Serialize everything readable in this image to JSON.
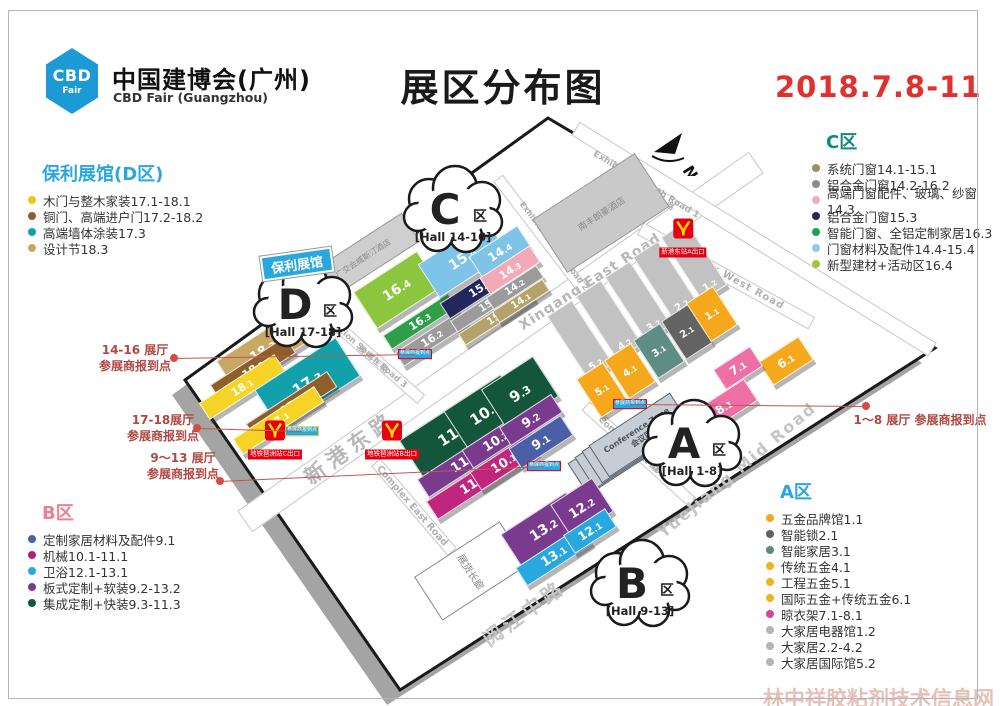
{
  "header": {
    "logo_main": "CBD",
    "logo_sub": "Fair",
    "org_cn": "中国建博会(广州)",
    "org_en": "CBD Fair (Guangzhou)",
    "title": "展区分布图",
    "date": "2018.7.8-11"
  },
  "legends": {
    "d": {
      "title": "保利展馆(D区)",
      "title_color": "#2AA7DF",
      "items": [
        {
          "color": "#F0C419",
          "label": "木门与整木家装17.1-18.1"
        },
        {
          "color": "#8F5F2B",
          "label": "铜门、高端进户门17.2-18.2"
        },
        {
          "color": "#12A0AA",
          "label": "高端墙体涂装17.3"
        },
        {
          "color": "#C9A765",
          "label": "设计节18.3"
        }
      ]
    },
    "c": {
      "title": "C区",
      "title_color": "#14887A",
      "items": [
        {
          "color": "#9D8D62",
          "label": "系统门窗14.1-15.1"
        },
        {
          "color": "#8C8C8C",
          "label": "铝合金门窗14.2-16.2"
        },
        {
          "color": "#F2A9B8",
          "label": "高端门窗配件、玻璃、纱窗14.3"
        },
        {
          "color": "#23275B",
          "label": "铝合金门窗15.3"
        },
        {
          "color": "#1E9E50",
          "label": "智能门窗、全铝定制家居16.3"
        },
        {
          "color": "#8EC8EA",
          "label": "门窗材料及配件14.4-15.4"
        },
        {
          "color": "#9AC93E",
          "label": "新型建材+活动区16.4"
        }
      ]
    },
    "b": {
      "title": "B区",
      "title_color": "#EB8093",
      "items": [
        {
          "color": "#4A5FA5",
          "label": "定制家居材料及配件9.1"
        },
        {
          "color": "#B01F7C",
          "label": "机械10.1-11.1"
        },
        {
          "color": "#29ABE2",
          "label": "卫浴12.1-13.1"
        },
        {
          "color": "#7A3B8F",
          "label": "板式定制+软装9.2-13.2"
        },
        {
          "color": "#0E5A3C",
          "label": "集成定制+快装9.3-11.3"
        }
      ]
    },
    "a": {
      "title": "A区",
      "title_color": "#2AA7DF",
      "items": [
        {
          "color": "#F2A71F",
          "label": "五金品牌馆1.1"
        },
        {
          "color": "#5F6062",
          "label": "智能锁2.1"
        },
        {
          "color": "#5B8A86",
          "label": "智能家居3.1"
        },
        {
          "color": "#F0B41F",
          "label": "传统五金4.1"
        },
        {
          "color": "#F0B41F",
          "label": "工程五金5.1"
        },
        {
          "color": "#F0B41F",
          "label": "国际五金+传统五金6.1"
        },
        {
          "color": "#D4439C",
          "label": "晾衣架7.1-8.1"
        },
        {
          "color": "#B5B5B5",
          "label": "大家居电器馆1.2"
        },
        {
          "color": "#B5B5B5",
          "label": "大家居2.2-4.2"
        },
        {
          "color": "#B5B5B5",
          "label": "大家居国际馆5.2"
        }
      ]
    }
  },
  "map": {
    "north": "N",
    "poly_tag": "保利展馆",
    "boundary": [
      [
        548,
        118
      ],
      [
        935,
        348
      ],
      [
        400,
        690
      ],
      [
        185,
        380
      ]
    ],
    "roads": [
      {
        "name": "xingang-east-road",
        "x1": 245,
        "y1": 520,
        "x2": 755,
        "y2": 162,
        "w": 24
      },
      {
        "name": "exhibition-south-road-1",
        "x1": 575,
        "y1": 128,
        "x2": 930,
        "y2": 348,
        "w": 14
      },
      {
        "name": "complex-west-road",
        "x1": 640,
        "y1": 228,
        "x2": 810,
        "y2": 322,
        "w": 12
      },
      {
        "name": "exhibition-south-road-2",
        "x1": 498,
        "y1": 178,
        "x2": 608,
        "y2": 322,
        "w": 10
      },
      {
        "name": "exhibition-south-road-3",
        "x1": 320,
        "y1": 310,
        "x2": 420,
        "y2": 398,
        "w": 10
      },
      {
        "name": "complex-mid-road",
        "x1": 585,
        "y1": 405,
        "x2": 690,
        "y2": 500,
        "w": 10
      },
      {
        "name": "complex-east-road",
        "x1": 375,
        "y1": 462,
        "x2": 450,
        "y2": 550,
        "w": 10
      }
    ],
    "road_labels": [
      {
        "name": "xingang-east-road-cn",
        "text": "新港东路",
        "x": 350,
        "y": 447,
        "rot": -36,
        "size": 21,
        "ls": 6,
        "color": "#b8b8b8"
      },
      {
        "name": "xingang-east-road-en",
        "text": "Xingang East Road",
        "x": 590,
        "y": 282,
        "rot": -33,
        "size": 14,
        "ls": 1,
        "color": "#b8b8b8"
      },
      {
        "name": "exhibition-south-road-1-en",
        "text": "Exhibition South Road 1",
        "x": 646,
        "y": 185,
        "rot": 31,
        "size": 9,
        "ls": 0,
        "color": "#b0b0b0"
      },
      {
        "name": "exhibition-south-road-1-cn",
        "text": "展南一路",
        "x": 658,
        "y": 199,
        "rot": 31,
        "size": 8,
        "ls": 2,
        "color": "#b0b0b0"
      },
      {
        "name": "complex-west-road-en",
        "text": "Complex West Road",
        "x": 727,
        "y": 276,
        "rot": 29,
        "size": 10,
        "ls": 1,
        "color": "#b0b0b0"
      },
      {
        "name": "exhibition-south-road-2-en",
        "text": "Exhibition South Road 2",
        "x": 554,
        "y": 246,
        "rot": 53,
        "size": 8,
        "ls": 0,
        "color": "#b0b0b0"
      },
      {
        "name": "exhibition-south-road-2-cn",
        "text": "展南二路",
        "x": 566,
        "y": 254,
        "rot": 53,
        "size": 7.5,
        "ls": 2,
        "color": "#b0b0b0"
      },
      {
        "name": "exhibition-south-road-3-en",
        "text": "Exhibition South Road 3",
        "x": 362,
        "y": 349,
        "rot": 41,
        "size": 8.5,
        "ls": 0,
        "color": "#b0b0b0"
      },
      {
        "name": "exhibition-south-road-3-cn",
        "text": "展南三路",
        "x": 374,
        "y": 360,
        "rot": 41,
        "size": 8,
        "ls": 2,
        "color": "#b0b0b0"
      },
      {
        "name": "complex-mid-road-en",
        "text": "Complex Mid Road",
        "x": 634,
        "y": 450,
        "rot": 42,
        "size": 9,
        "ls": 0,
        "color": "#b0b0b0"
      },
      {
        "name": "complex-mid-road-cn",
        "text": "展览中路",
        "x": 645,
        "y": 459,
        "rot": 42,
        "size": 8,
        "ls": 2,
        "color": "#b0b0b0"
      },
      {
        "name": "complex-east-road-en",
        "text": "Complex East Road",
        "x": 412,
        "y": 506,
        "rot": 49,
        "size": 9.5,
        "ls": 0,
        "color": "#b0b0b0"
      },
      {
        "name": "yuejiang-mid-road-en",
        "text": "Yuejiang Mid Road",
        "x": 737,
        "y": 470,
        "rot": -40,
        "size": 16,
        "ls": 2,
        "color": "#c5c5c5"
      },
      {
        "name": "yuejiang-mid-road-cn",
        "text": "阅江中路",
        "x": 523,
        "y": 612,
        "rot": -36,
        "size": 20,
        "ls": 4,
        "color": "#c5c5c5"
      }
    ],
    "buildings": [
      {
        "name": "nanfeng-langham-hotel",
        "label": "南丰朗豪酒店",
        "x": 600,
        "y": 212,
        "w": 120,
        "h": 62,
        "fill": "#C9C9C9",
        "border": "#9a9a9a",
        "fz": 9
      },
      {
        "name": "westin-hotel",
        "label": "广交会威斯汀酒店",
        "x": 362,
        "y": 257,
        "w": 112,
        "h": 32,
        "fill": "#CFCFCF",
        "border": "#9a9a9a",
        "fz": 8
      },
      {
        "name": "exhibition-corridor",
        "label": "展货长廊",
        "x": 470,
        "y": 570,
        "w": 100,
        "h": 50,
        "fill": "#ffffff",
        "border": "#8a8a8a",
        "fz": 10,
        "vert": true
      }
    ],
    "conference": {
      "x": 617,
      "y": 452,
      "w": 95,
      "h": 36,
      "label_en": "Conference Zone",
      "label_cn": "会议区"
    },
    "halls": [
      {
        "id": "18.3",
        "x": 262,
        "y": 350,
        "w": 88,
        "h": 32,
        "c": "#C9A765",
        "fz": 13
      },
      {
        "id": "18.2",
        "x": 252,
        "y": 368,
        "w": 88,
        "h": 18,
        "c": "#8F5F2B",
        "fz": 11
      },
      {
        "id": "18.1",
        "x": 241,
        "y": 386,
        "w": 88,
        "h": 18,
        "c": "#F5D327",
        "fz": 11
      },
      {
        "id": "17.3",
        "x": 306,
        "y": 382,
        "w": 95,
        "h": 44,
        "c": "#12A0AA",
        "fz": 15
      },
      {
        "id": "17.2",
        "x": 290,
        "y": 404,
        "w": 95,
        "h": 17,
        "c": "#8F5F2B",
        "fz": 11
      },
      {
        "id": "17.1",
        "x": 277,
        "y": 419,
        "w": 95,
        "h": 17,
        "c": "#F5D327",
        "fz": 11
      },
      {
        "id": "16.4",
        "x": 396,
        "y": 289,
        "w": 74,
        "h": 42,
        "c": "#8CC63E",
        "fz": 14
      },
      {
        "id": "16.3",
        "x": 419,
        "y": 320,
        "w": 76,
        "h": 15,
        "c": "#2E9E4B",
        "fz": 11
      },
      {
        "id": "16.2",
        "x": 431,
        "y": 337,
        "w": 76,
        "h": 15,
        "c": "#9B9B9B",
        "fz": 11
      },
      {
        "id": "15.4",
        "x": 462,
        "y": 258,
        "w": 80,
        "h": 38,
        "c": "#7EC3E8",
        "fz": 14
      },
      {
        "id": "15.3",
        "x": 479,
        "y": 287,
        "w": 82,
        "h": 17,
        "c": "#23275B",
        "fz": 11
      },
      {
        "id": "15.2",
        "x": 488,
        "y": 303,
        "w": 82,
        "h": 12,
        "c": "#9B9B9B",
        "fz": 10
      },
      {
        "id": "15.1",
        "x": 496,
        "y": 316,
        "w": 82,
        "h": 12,
        "c": "#B3A269",
        "fz": 10
      },
      {
        "id": "14.4",
        "x": 499,
        "y": 251,
        "w": 56,
        "h": 24,
        "c": "#7EC3E8",
        "fz": 12
      },
      {
        "id": "14.3",
        "x": 509,
        "y": 269,
        "w": 58,
        "h": 18,
        "c": "#F2A9B8",
        "fz": 11
      },
      {
        "id": "14.2",
        "x": 514,
        "y": 286,
        "w": 58,
        "h": 13,
        "c": "#9B9B9B",
        "fz": 10
      },
      {
        "id": "14.1",
        "x": 520,
        "y": 300,
        "w": 58,
        "h": 12,
        "c": "#B3A269",
        "fz": 10
      },
      {
        "id": "11.3",
        "x": 452,
        "y": 433,
        "w": 96,
        "h": 46,
        "c": "#14563B",
        "fz": 15
      },
      {
        "id": "11.2",
        "x": 463,
        "y": 461,
        "w": 96,
        "h": 20,
        "c": "#7A3B8F",
        "fz": 13
      },
      {
        "id": "11.1",
        "x": 472,
        "y": 483,
        "w": 96,
        "h": 20,
        "c": "#C0267E",
        "fz": 13
      },
      {
        "id": "10.3",
        "x": 484,
        "y": 412,
        "w": 66,
        "h": 46,
        "c": "#14563B",
        "fz": 15
      },
      {
        "id": "10.2",
        "x": 495,
        "y": 440,
        "w": 66,
        "h": 20,
        "c": "#7A3B8F",
        "fz": 13
      },
      {
        "id": "10.1",
        "x": 503,
        "y": 462,
        "w": 66,
        "h": 20,
        "c": "#C0267E",
        "fz": 13
      },
      {
        "id": "9.3",
        "x": 519,
        "y": 392,
        "w": 60,
        "h": 46,
        "c": "#14563B",
        "fz": 15
      },
      {
        "id": "9.2",
        "x": 530,
        "y": 419,
        "w": 60,
        "h": 20,
        "c": "#7A3B8F",
        "fz": 13
      },
      {
        "id": "9.1",
        "x": 540,
        "y": 441,
        "w": 60,
        "h": 22,
        "c": "#4A5FA5",
        "fz": 13
      },
      {
        "id": "13.2",
        "x": 543,
        "y": 529,
        "w": 76,
        "h": 38,
        "c": "#7A3B8F",
        "fz": 14
      },
      {
        "id": "13.1",
        "x": 553,
        "y": 555,
        "w": 76,
        "h": 20,
        "c": "#29A8E0",
        "fz": 13
      },
      {
        "id": "12.2",
        "x": 581,
        "y": 507,
        "w": 48,
        "h": 38,
        "c": "#7A3B8F",
        "fz": 13
      },
      {
        "id": "12.1",
        "x": 589,
        "y": 530,
        "w": 48,
        "h": 20,
        "c": "#29A8E0",
        "fz": 12
      },
      {
        "id": "5.2",
        "x": 580,
        "y": 340,
        "w": 30,
        "h": 76,
        "c": "#C2C2C2",
        "fz": 10,
        "lp": "b"
      },
      {
        "id": "4.2",
        "x": 609,
        "y": 320,
        "w": 30,
        "h": 76,
        "c": "#C2C2C2",
        "fz": 10,
        "lp": "b"
      },
      {
        "id": "3.2",
        "x": 638,
        "y": 301,
        "w": 30,
        "h": 76,
        "c": "#C2C2C2",
        "fz": 10,
        "lp": "b"
      },
      {
        "id": "2.2",
        "x": 666,
        "y": 281,
        "w": 30,
        "h": 76,
        "c": "#C2C2C2",
        "fz": 10,
        "lp": "b"
      },
      {
        "id": "1.2",
        "x": 694,
        "y": 261,
        "w": 30,
        "h": 76,
        "c": "#C2C2C2",
        "fz": 10,
        "lp": "b"
      },
      {
        "id": "5.1",
        "x": 601,
        "y": 389,
        "w": 30,
        "h": 44,
        "c": "#F5A81C",
        "fz": 10
      },
      {
        "id": "4.1",
        "x": 629,
        "y": 370,
        "w": 30,
        "h": 44,
        "c": "#F5A81C",
        "fz": 10
      },
      {
        "id": "3.1",
        "x": 658,
        "y": 350,
        "w": 30,
        "h": 44,
        "c": "#5E8D84",
        "fz": 10
      },
      {
        "id": "2.1",
        "x": 686,
        "y": 331,
        "w": 30,
        "h": 44,
        "c": "#636363",
        "fz": 10
      },
      {
        "id": "1.1",
        "x": 711,
        "y": 313,
        "w": 30,
        "h": 44,
        "c": "#F5A81C",
        "fz": 10
      },
      {
        "id": "6.1",
        "x": 785,
        "y": 360,
        "w": 46,
        "h": 26,
        "c": "#F5A81C",
        "fz": 12
      },
      {
        "id": "7.1",
        "x": 737,
        "y": 367,
        "w": 42,
        "h": 22,
        "c": "#EE6FA5",
        "fz": 12
      },
      {
        "id": "8.1",
        "x": 723,
        "y": 406,
        "w": 62,
        "h": 24,
        "c": "#EE6FA5",
        "fz": 12
      }
    ],
    "clouds": [
      {
        "letter": "C",
        "suffix": "区",
        "hall": "[Hall 14-16]",
        "x": 453,
        "y": 212
      },
      {
        "letter": "D",
        "suffix": "区",
        "hall": "[Hall 17-18]",
        "x": 303,
        "y": 307
      },
      {
        "letter": "A",
        "suffix": "区",
        "hall": "[Hall 1-8]",
        "x": 692,
        "y": 446
      },
      {
        "letter": "B",
        "suffix": "区",
        "hall": "[Hall 9-13]",
        "x": 640,
        "y": 586
      }
    ],
    "metro": [
      {
        "label": "新港东站A出口",
        "x": 683,
        "y": 238
      },
      {
        "label": "地铁琶洲站C出口",
        "x": 275,
        "y": 440
      },
      {
        "label": "地铁琶洲站B出口",
        "x": 392,
        "y": 440
      }
    ],
    "signs": [
      {
        "label": "参展商报到点",
        "x": 415,
        "y": 354,
        "bc": "#E60012"
      },
      {
        "label": "参展商报到点",
        "x": 302,
        "y": 431,
        "bc": "#F5D327"
      },
      {
        "label": "参展商报到点",
        "x": 544,
        "y": 466,
        "bc": "#E60012"
      },
      {
        "label": "参展商报到点",
        "x": 630,
        "y": 404,
        "bc": "#E60012"
      }
    ],
    "annotations": [
      {
        "name": "checkin-14-16",
        "lines": [
          "14-16 展厅",
          "参展商报到点"
        ],
        "tx": 85,
        "ty": 343,
        "tw": 100,
        "dot": [
          174,
          358
        ],
        "line": [
          174,
          358,
          415,
          354
        ]
      },
      {
        "name": "checkin-17-18",
        "lines": [
          "17-18展厅",
          "参展商报到点"
        ],
        "tx": 113,
        "ty": 413,
        "tw": 100,
        "dot": [
          197,
          428
        ],
        "line": [
          197,
          428,
          302,
          431
        ]
      },
      {
        "name": "checkin-9-13",
        "lines": [
          "9～13 展厅",
          "参展商报到点"
        ],
        "tx": 128,
        "ty": 451,
        "tw": 110,
        "dot": [
          220,
          481
        ],
        "line": [
          220,
          481,
          544,
          466
        ]
      },
      {
        "name": "checkin-1-8",
        "lines": [
          "1～8 展厅  参展商报到点"
        ],
        "tx": 845,
        "ty": 413,
        "tw": 150,
        "dot": [
          866,
          406
        ],
        "line": [
          630,
          404,
          866,
          406
        ]
      }
    ],
    "watermark": "林中祥胶粘剂技术信息网"
  }
}
